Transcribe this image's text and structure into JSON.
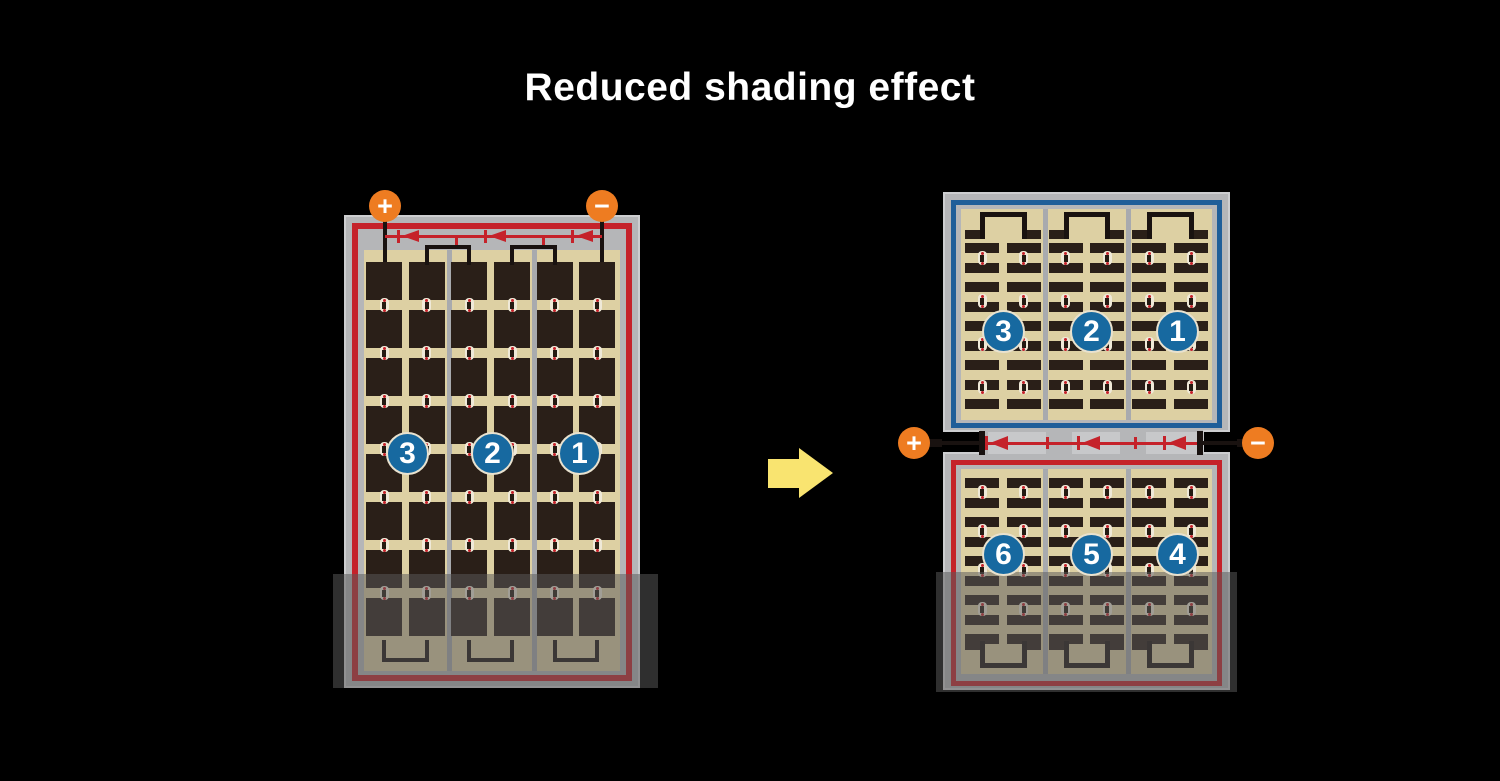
{
  "title": "Reduced shading effect",
  "colors": {
    "background": "#000000",
    "title_text": "#ffffff",
    "frame_gray": "#b5b6b8",
    "frame_edge": "#cdced0",
    "red": "#c5222a",
    "blue": "#1f5e99",
    "tan": "#ddd0a3",
    "cell": "#2a1f18",
    "divider": "#a8aaae",
    "orange": "#ee7c21",
    "circle_blue": "#1769a0",
    "circle_ring": "#e9e2cf",
    "wire": "#191210",
    "arrow": "#f9e470",
    "dot_bg": "#efe9d8",
    "dot_core": "#241a12",
    "junction_block": "#c7c8ca",
    "shade": "rgba(90,90,90,0.52)"
  },
  "left_panel": {
    "terminals": {
      "positive": "+",
      "negative": "−"
    },
    "sections": [
      {
        "label": "3"
      },
      {
        "label": "2"
      },
      {
        "label": "1"
      }
    ],
    "bypass_diodes": 3,
    "shaded": true
  },
  "right_top_panel": {
    "sections": [
      {
        "label": "3"
      },
      {
        "label": "2"
      },
      {
        "label": "1"
      }
    ],
    "shaded": false
  },
  "right_bottom_panel": {
    "sections": [
      {
        "label": "6"
      },
      {
        "label": "5"
      },
      {
        "label": "4"
      }
    ],
    "shaded": true
  },
  "junction": {
    "terminals": {
      "positive": "+",
      "negative": "−"
    },
    "bypass_diodes": 3
  }
}
